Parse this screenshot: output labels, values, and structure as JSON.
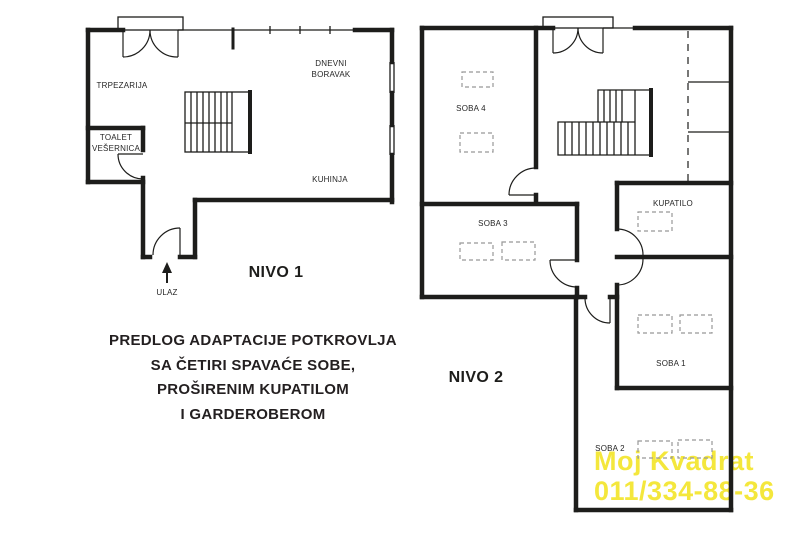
{
  "palette": {
    "wall": "#1d1d1b",
    "label": "#262626",
    "dashed_skylight": "#989898",
    "watermark": "#f4e73c",
    "background": "#ffffff"
  },
  "level1": {
    "title": "NIVO 1",
    "rooms": {
      "trpezarija": "TRPEZARIJA",
      "dnevni_line1": "DNEVNI",
      "dnevni_line2": "BORAVAK",
      "toalet_line1": "TOALET",
      "toalet_line2": "VEŠERNICA",
      "kuhinja": "KUHINJA"
    },
    "entrance": "ULAZ"
  },
  "level2": {
    "title": "NIVO 2",
    "rooms": {
      "soba4": "SOBA 4",
      "soba3": "SOBA 3",
      "kupatilo": "KUPATILO",
      "soba1": "SOBA 1",
      "soba2": "SOBA 2"
    }
  },
  "description": {
    "line1": "PREDLOG ADAPTACIJE POTKROVLJA",
    "line2": "SA ČETIRI SPAVAĆE SOBE,",
    "line3": "PROŠIRENIM KUPATILOM",
    "line4": "I GARDEROBEROM"
  },
  "watermark": {
    "line1": "Moj Kvadrat",
    "line2": "011/334-88-36"
  }
}
